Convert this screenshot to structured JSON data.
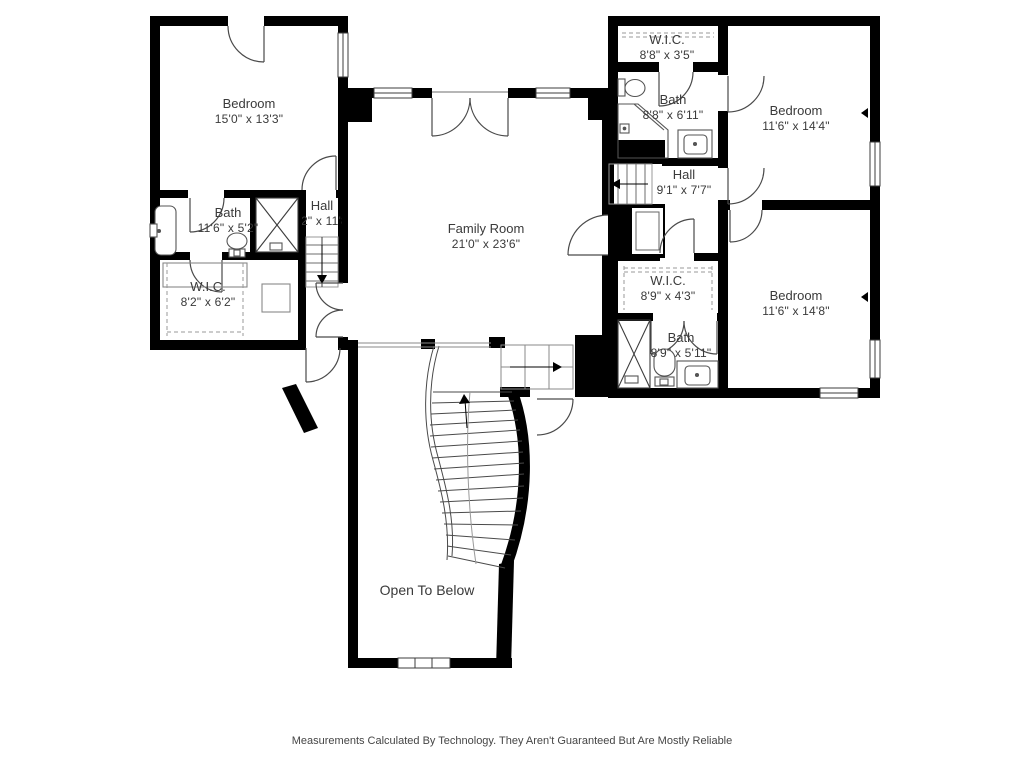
{
  "rooms": {
    "bedroom_left": {
      "name": "Bedroom",
      "dims": "15'0\" x 13'3\""
    },
    "bath_left": {
      "name": "Bath",
      "dims": "11'6\" x 5'2\""
    },
    "wic_left": {
      "name": "W.I.C.",
      "dims": "8'2\" x 6'2\""
    },
    "hall_left": {
      "name": "Hall",
      "dims": "4'2\" x 11'8\""
    },
    "family_room": {
      "name": "Family Room",
      "dims": "21'0\" x 23'6\""
    },
    "wic_top_right": {
      "name": "W.I.C.",
      "dims": "8'8\" x 3'5\""
    },
    "bath_top_right": {
      "name": "Bath",
      "dims": "8'8\" x 6'11\""
    },
    "hall_right": {
      "name": "Hall",
      "dims": "9'1\" x 7'7\""
    },
    "bedroom_top_right": {
      "name": "Bedroom",
      "dims": "11'6\" x 14'4\""
    },
    "wic_mid_right": {
      "name": "W.I.C.",
      "dims": "8'9\" x 4'3\""
    },
    "bath_bottom_right": {
      "name": "Bath",
      "dims": "8'9\" x 5'11\""
    },
    "bedroom_bottom_right": {
      "name": "Bedroom",
      "dims": "11'6\" x 14'8\""
    },
    "open_to_below": {
      "name": "Open To Below",
      "dims": ""
    }
  },
  "disclaimer": "Measurements Calculated By Technology. They Aren't Guaranteed But Are Mostly Reliable",
  "colors": {
    "wall": "#000000",
    "label_text": "#3a3a3a",
    "background": "#ffffff"
  }
}
